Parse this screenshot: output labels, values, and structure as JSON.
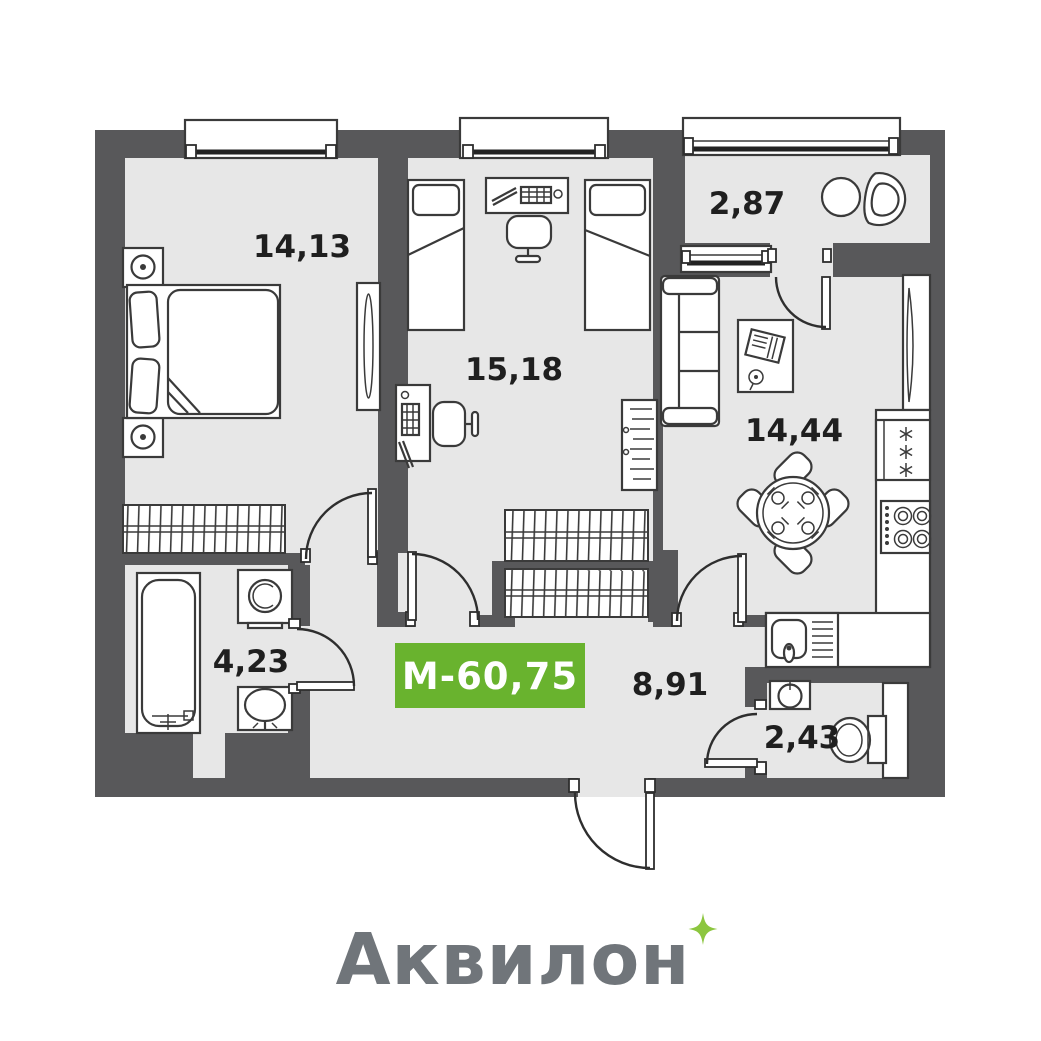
{
  "plan": {
    "title": "apartment-floor-plan",
    "rooms": [
      {
        "name": "bedroom",
        "area": "14,13"
      },
      {
        "name": "children-room",
        "area": "15,18"
      },
      {
        "name": "loggia",
        "area": "2,87"
      },
      {
        "name": "kitchen-living-room",
        "area": "14,44"
      },
      {
        "name": "bathroom",
        "area": "4,23"
      },
      {
        "name": "hallway",
        "area": "8,91"
      },
      {
        "name": "toilet",
        "area": "2,43"
      }
    ],
    "badge": {
      "label": "М-60,75",
      "bg_color": "#69b32e",
      "text_color": "#ffffff"
    },
    "furniture_icons": [
      "double-bed",
      "nightstand-lamp",
      "wardrobe",
      "mirror",
      "single-bed",
      "desk-computer",
      "desk-chair",
      "drying-rack",
      "round-table",
      "balcony-chair",
      "sofa",
      "coffee-table",
      "dining-table-4-chairs",
      "worktop",
      "fridge",
      "stove",
      "kitchen-sink",
      "bathtub",
      "washing-machine",
      "washbasin",
      "toilet-bowl",
      "window",
      "door-swing"
    ]
  },
  "logo": {
    "text": "Аквилон",
    "color": "#70757a",
    "sparkle_color": "#8cc63f"
  },
  "colors": {
    "background": "#ffffff",
    "wall": "#58585a",
    "floor": "#e7e7e7",
    "line": "#3a3a3a",
    "label": "#1f1f1f"
  }
}
